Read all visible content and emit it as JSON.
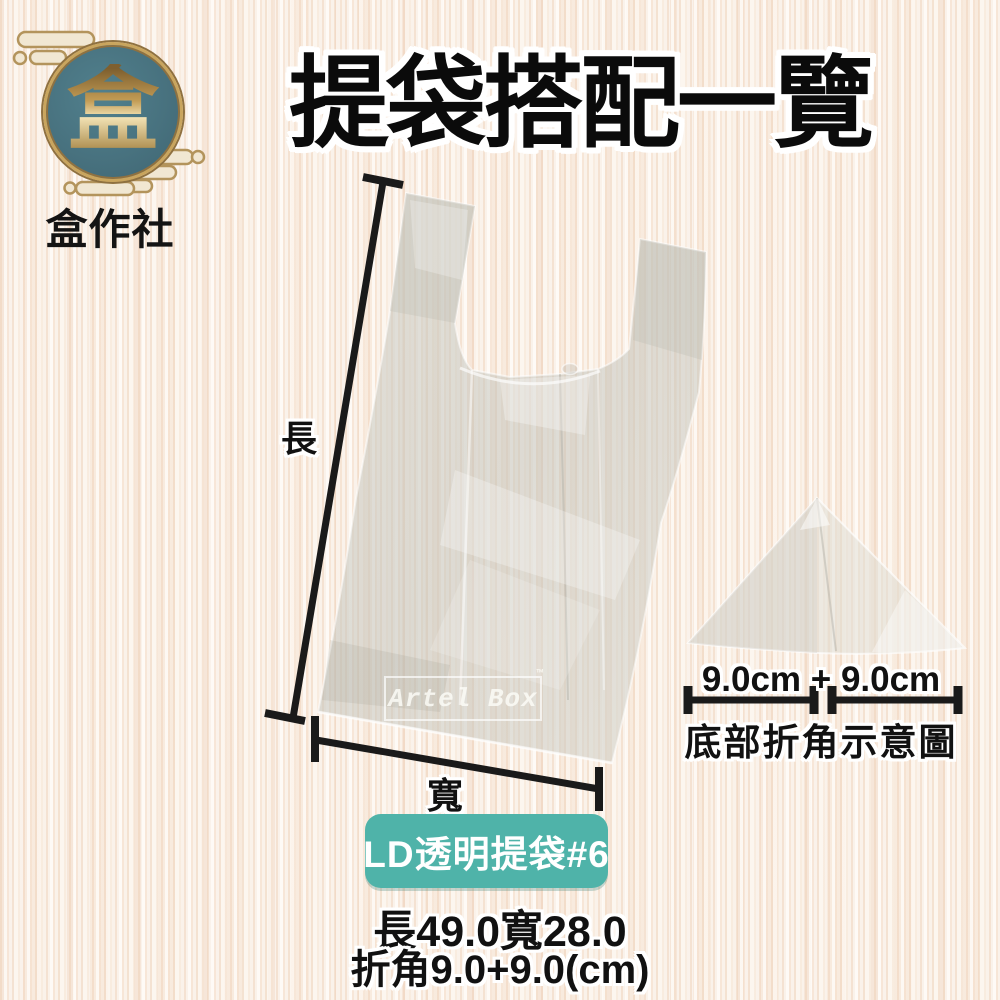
{
  "brand": {
    "logo_char": "盒",
    "name": "盒作社"
  },
  "title": "提袋搭配一覽",
  "bag_diagram": {
    "length_label": "長",
    "width_label": "寬",
    "watermark": "Artel Box",
    "watermark_tm": "™"
  },
  "fold_diagram": {
    "measurement": "9.0cm + 9.0cm",
    "caption": "底部折角示意圖"
  },
  "product": {
    "badge": "LD透明提袋#6",
    "spec_line1": "長49.0寬28.0",
    "spec_line2": "折角9.0+9.0(cm)"
  },
  "colors": {
    "badge_teal": "#4fb3a9",
    "logo_teal": "#48727f",
    "logo_gold": "#c9a55e",
    "text_black": "#111111"
  }
}
